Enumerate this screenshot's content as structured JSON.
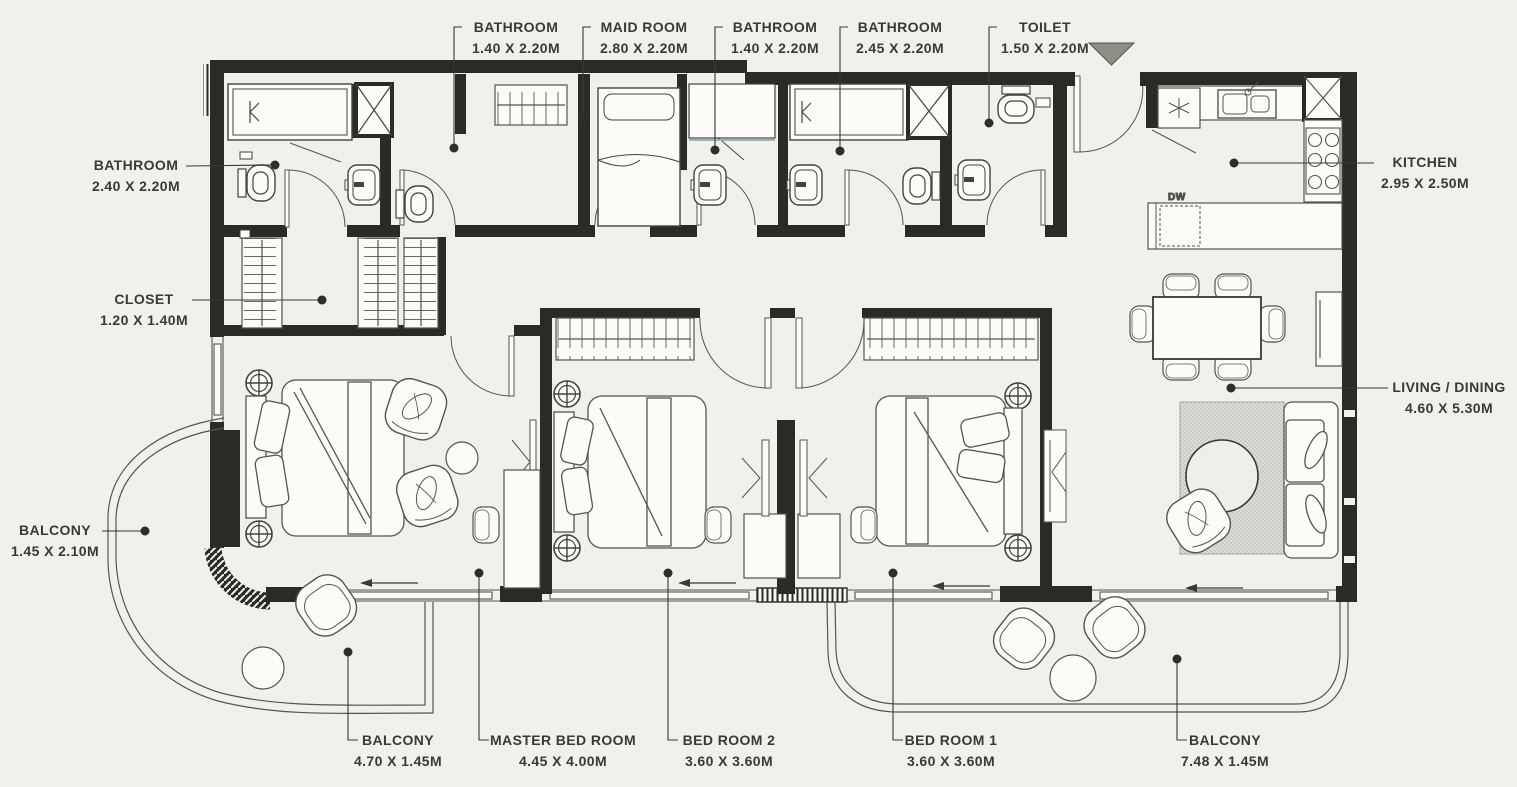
{
  "colors": {
    "background": "#f2f0ea",
    "wall": "#2b2a26",
    "line": "#57564f",
    "text": "#3a3935",
    "entry_marker": "#8e8d86",
    "rug": "#dcdbd5"
  },
  "annotations": {
    "dishwasher": "DW"
  },
  "labels": {
    "bathroom_top_1": {
      "name": "BATHROOM",
      "dims": "1.40 X 2.20M"
    },
    "maid_room": {
      "name": "MAID ROOM",
      "dims": "2.80 X 2.20M"
    },
    "bathroom_top_2": {
      "name": "BATHROOM",
      "dims": "1.40 X 2.20M"
    },
    "bathroom_top_3": {
      "name": "BATHROOM",
      "dims": "2.45 X 2.20M"
    },
    "toilet": {
      "name": "TOILET",
      "dims": "1.50 X 2.20M"
    },
    "bathroom_left": {
      "name": "BATHROOM",
      "dims": "2.40 X 2.20M"
    },
    "closet": {
      "name": "CLOSET",
      "dims": "1.20 X 1.40M"
    },
    "balcony_left": {
      "name": "BALCONY",
      "dims": "1.45 X 2.10M"
    },
    "kitchen": {
      "name": "KITCHEN",
      "dims": "2.95 X 2.50M"
    },
    "living_dining": {
      "name": "LIVING / DINING",
      "dims": "4.60 X 5.30M"
    },
    "balcony_bottom_left": {
      "name": "BALCONY",
      "dims": "4.70 X 1.45M"
    },
    "master_bedroom": {
      "name": "MASTER BED ROOM",
      "dims": "4.45 X 4.00M"
    },
    "bedroom_2": {
      "name": "BED ROOM 2",
      "dims": "3.60 X 3.60M"
    },
    "bedroom_1": {
      "name": "BED ROOM 1",
      "dims": "3.60 X 3.60M"
    },
    "balcony_bottom_right": {
      "name": "BALCONY",
      "dims": "7.48 X 1.45M"
    }
  }
}
